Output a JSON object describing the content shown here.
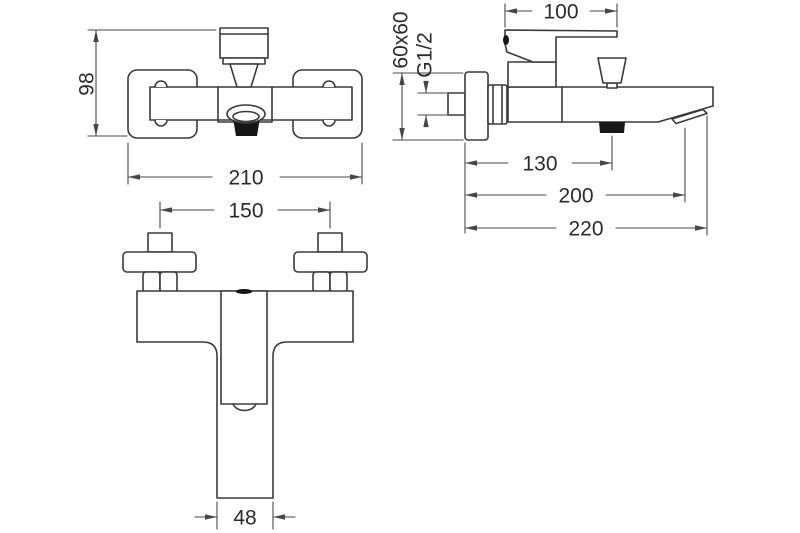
{
  "theme": {
    "bg": "#ffffff",
    "ln": "#3a3a3a",
    "dim": "#474747",
    "tx": "#2b2b2b",
    "dk": "#161616"
  },
  "drawing": {
    "front_view": {
      "height": "98",
      "width": "210"
    },
    "side_view": {
      "handle_length": "100",
      "escutcheon": "60x60",
      "thread": "G1/2",
      "outlet_offset": "130",
      "spout_reach": "200",
      "total_reach": "220"
    },
    "top_view": {
      "hole_centers": "150",
      "spout_width": "48"
    }
  }
}
